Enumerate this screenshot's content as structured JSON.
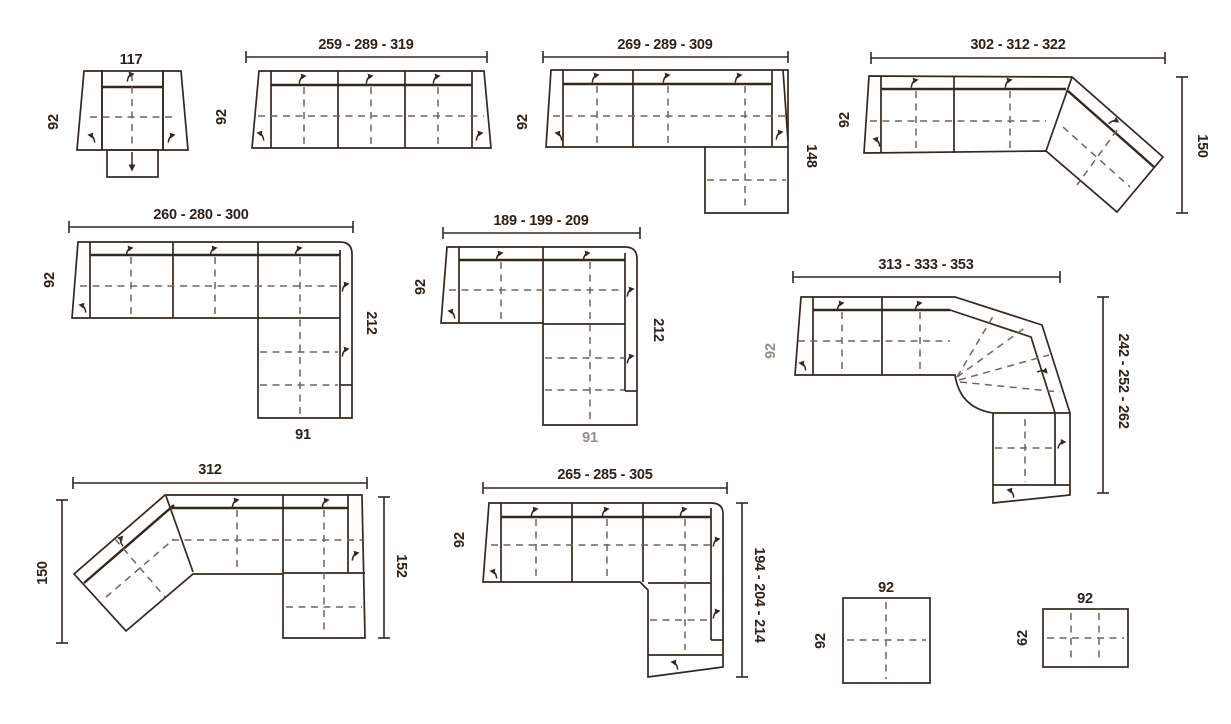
{
  "colors": {
    "line": "#34271e",
    "dash": "#6e655c",
    "text": "#2d221a",
    "text_muted": "#978e83",
    "bg": "#ffffff"
  },
  "diagrams": {
    "armchair": {
      "width": "117",
      "depth": "92"
    },
    "three_seat_sofa": {
      "width": "259 - 289 - 319",
      "depth": "92"
    },
    "chaise_sofa": {
      "width": "269 - 289 - 309",
      "depth": "92",
      "chaise_depth": "148"
    },
    "angled_end_sofa": {
      "width": "302 - 312 - 322",
      "depth": "92",
      "angled_depth": "150"
    },
    "corner_sofa_large": {
      "width": "260 - 280 - 300",
      "depth": "92",
      "side_depth": "212",
      "end_width": "91"
    },
    "corner_sofa_small": {
      "width": "189 - 199 - 209",
      "depth": "92",
      "side_depth": "212",
      "end_width": "91"
    },
    "curved_corner_sofa": {
      "width": "313 - 333 - 353",
      "depth": "92",
      "side_depth": "242 - 252 - 262"
    },
    "angled_start_sofa": {
      "width": "312",
      "left_depth": "150",
      "right_depth": "152"
    },
    "corner_chaise_sofa": {
      "width": "265 - 285 - 305",
      "depth": "92",
      "side_depth": "194 - 204 - 214"
    },
    "pouf_square": {
      "width": "92",
      "depth": "92"
    },
    "pouf_low": {
      "width": "92",
      "depth": "62"
    }
  }
}
